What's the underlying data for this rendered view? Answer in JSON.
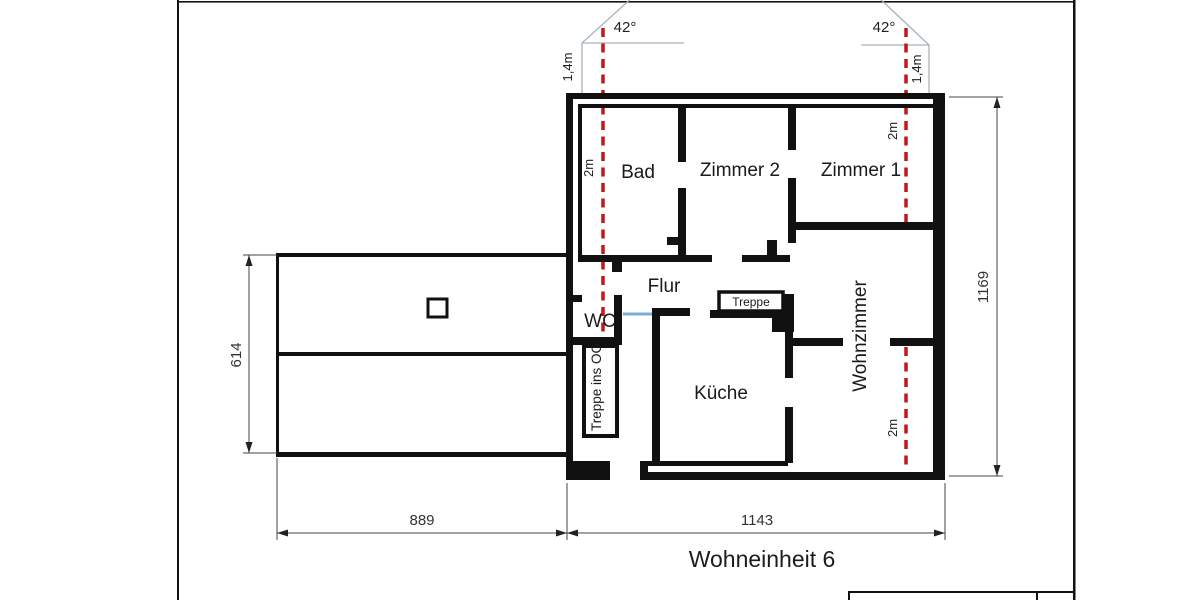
{
  "drawing": {
    "title": "Wohneinheit 6",
    "rooms": {
      "bad": "Bad",
      "zimmer2": "Zimmer 2",
      "zimmer1": "Zimmer 1",
      "flur": "Flur",
      "wc": "WC",
      "kueche": "Küche",
      "wohnzimmer": "Wohnzimmer",
      "treppe_box": "Treppe",
      "treppe_og": "Treppe ins OG"
    },
    "dimensions": {
      "left_building_height": "614",
      "left_building_width": "889",
      "main_building_width": "1143",
      "main_building_height": "1169"
    },
    "roof": {
      "angle_left": "42°",
      "angle_right": "42°",
      "knee_height_left": "1,4m",
      "knee_height_right": "1,4m"
    },
    "headroom": {
      "left": "2m",
      "right_top": "2m",
      "right_bottom": "2m"
    },
    "colors": {
      "wall": "#111111",
      "roof_line": "#a9b3bb",
      "headroom_line": "#c01818",
      "door_line": "#7badd8"
    }
  }
}
